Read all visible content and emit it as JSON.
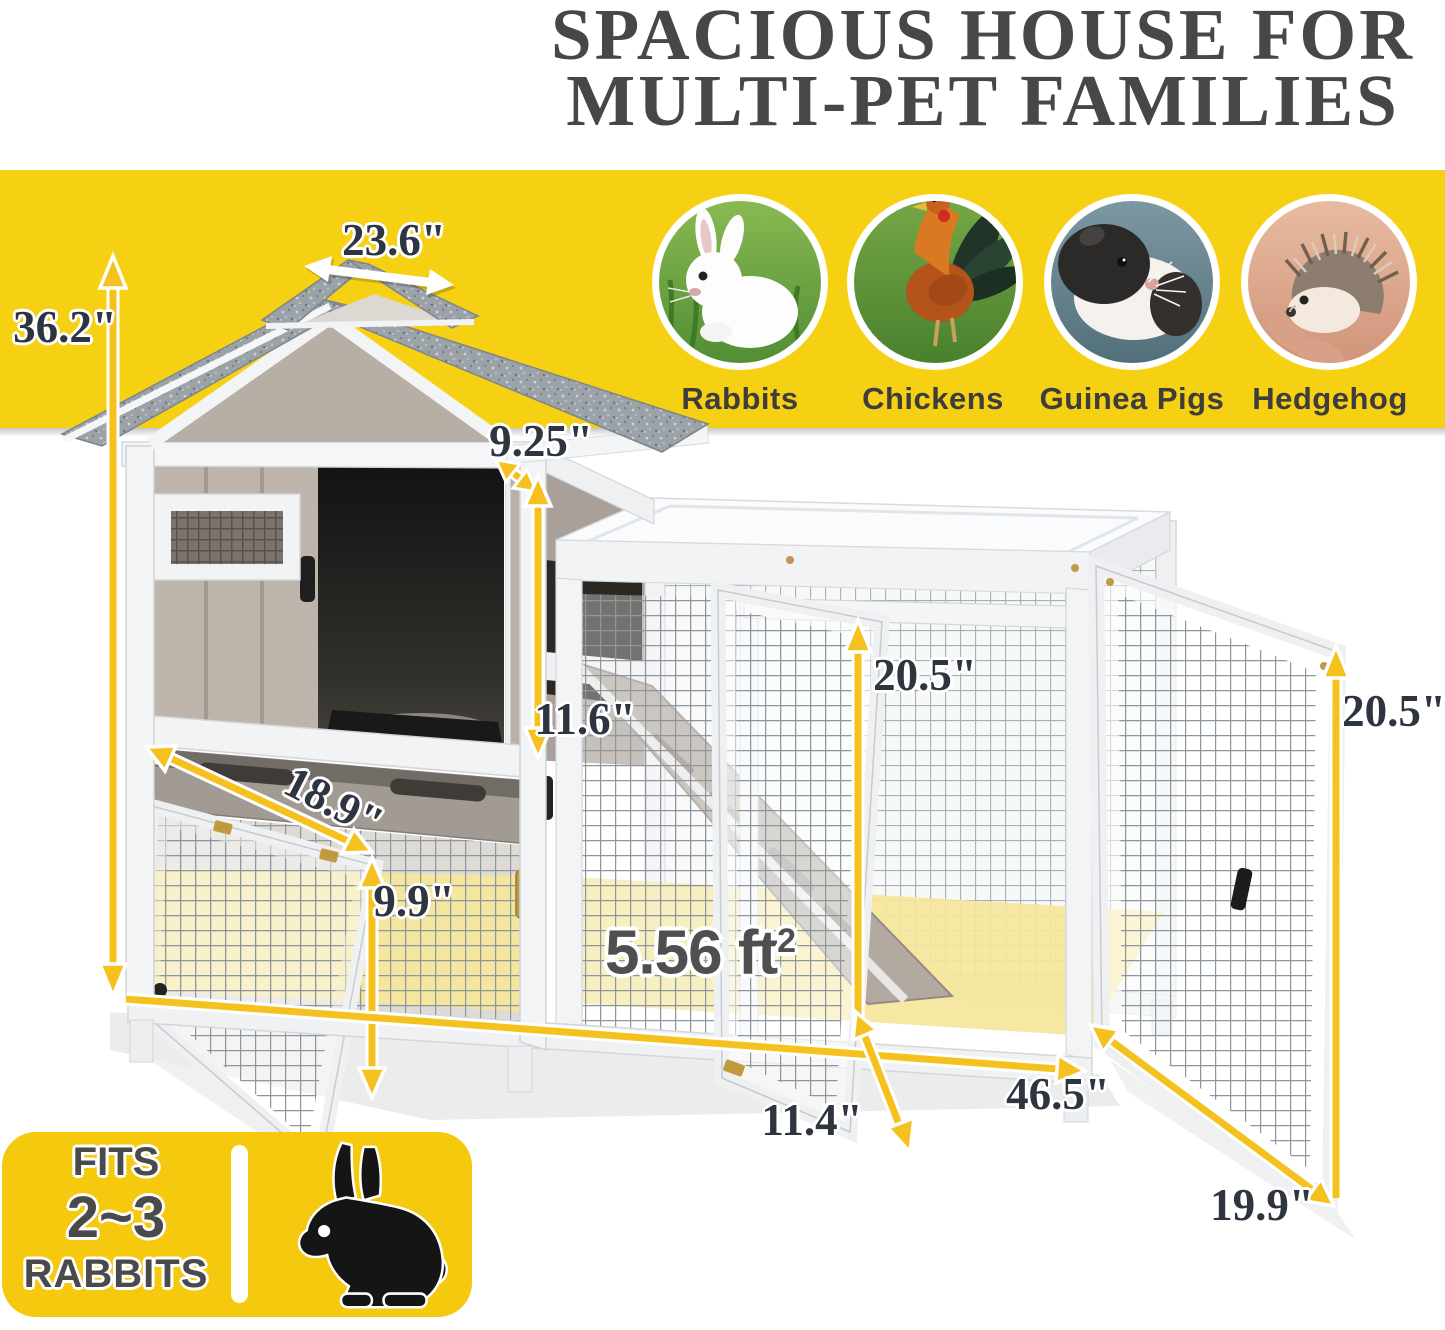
{
  "title": {
    "line1": "SPACIOUS HOUSE FOR",
    "line2": "MULTI-PET FAMILIES"
  },
  "animals": [
    {
      "name": "Rabbits"
    },
    {
      "name": "Chickens"
    },
    {
      "name": "Guinea Pigs"
    },
    {
      "name": "Hedgehog"
    }
  ],
  "dims": {
    "roof_width": "23.6\"",
    "total_height": "36.2\"",
    "side_opening_depth": "9.25\"",
    "house_door_height": "11.6\"",
    "lower_hutch_depth": "18.9\"",
    "lower_hutch_height": "9.9\"",
    "run_inner_height": "20.5\"",
    "side_door_height": "20.5\"",
    "area_value": "5.56 ft",
    "area_sup": "2",
    "total_length": "46.5\"",
    "front_door_width": "11.4\"",
    "side_door_width": "19.9\""
  },
  "badge": {
    "line1": "FITS",
    "line2": "2~3",
    "line3": "RABBITS"
  },
  "colors": {
    "band_yellow": "#F6D013",
    "badge_yellow": "#F4C90E",
    "arrow_gold": "#F4C11F",
    "dim_text": "#2F3540",
    "title_gray": "#474747",
    "floor_highlight": "#F5E69A",
    "label_gray": "#3D3D3D",
    "area_text": "#4F4F4F"
  }
}
